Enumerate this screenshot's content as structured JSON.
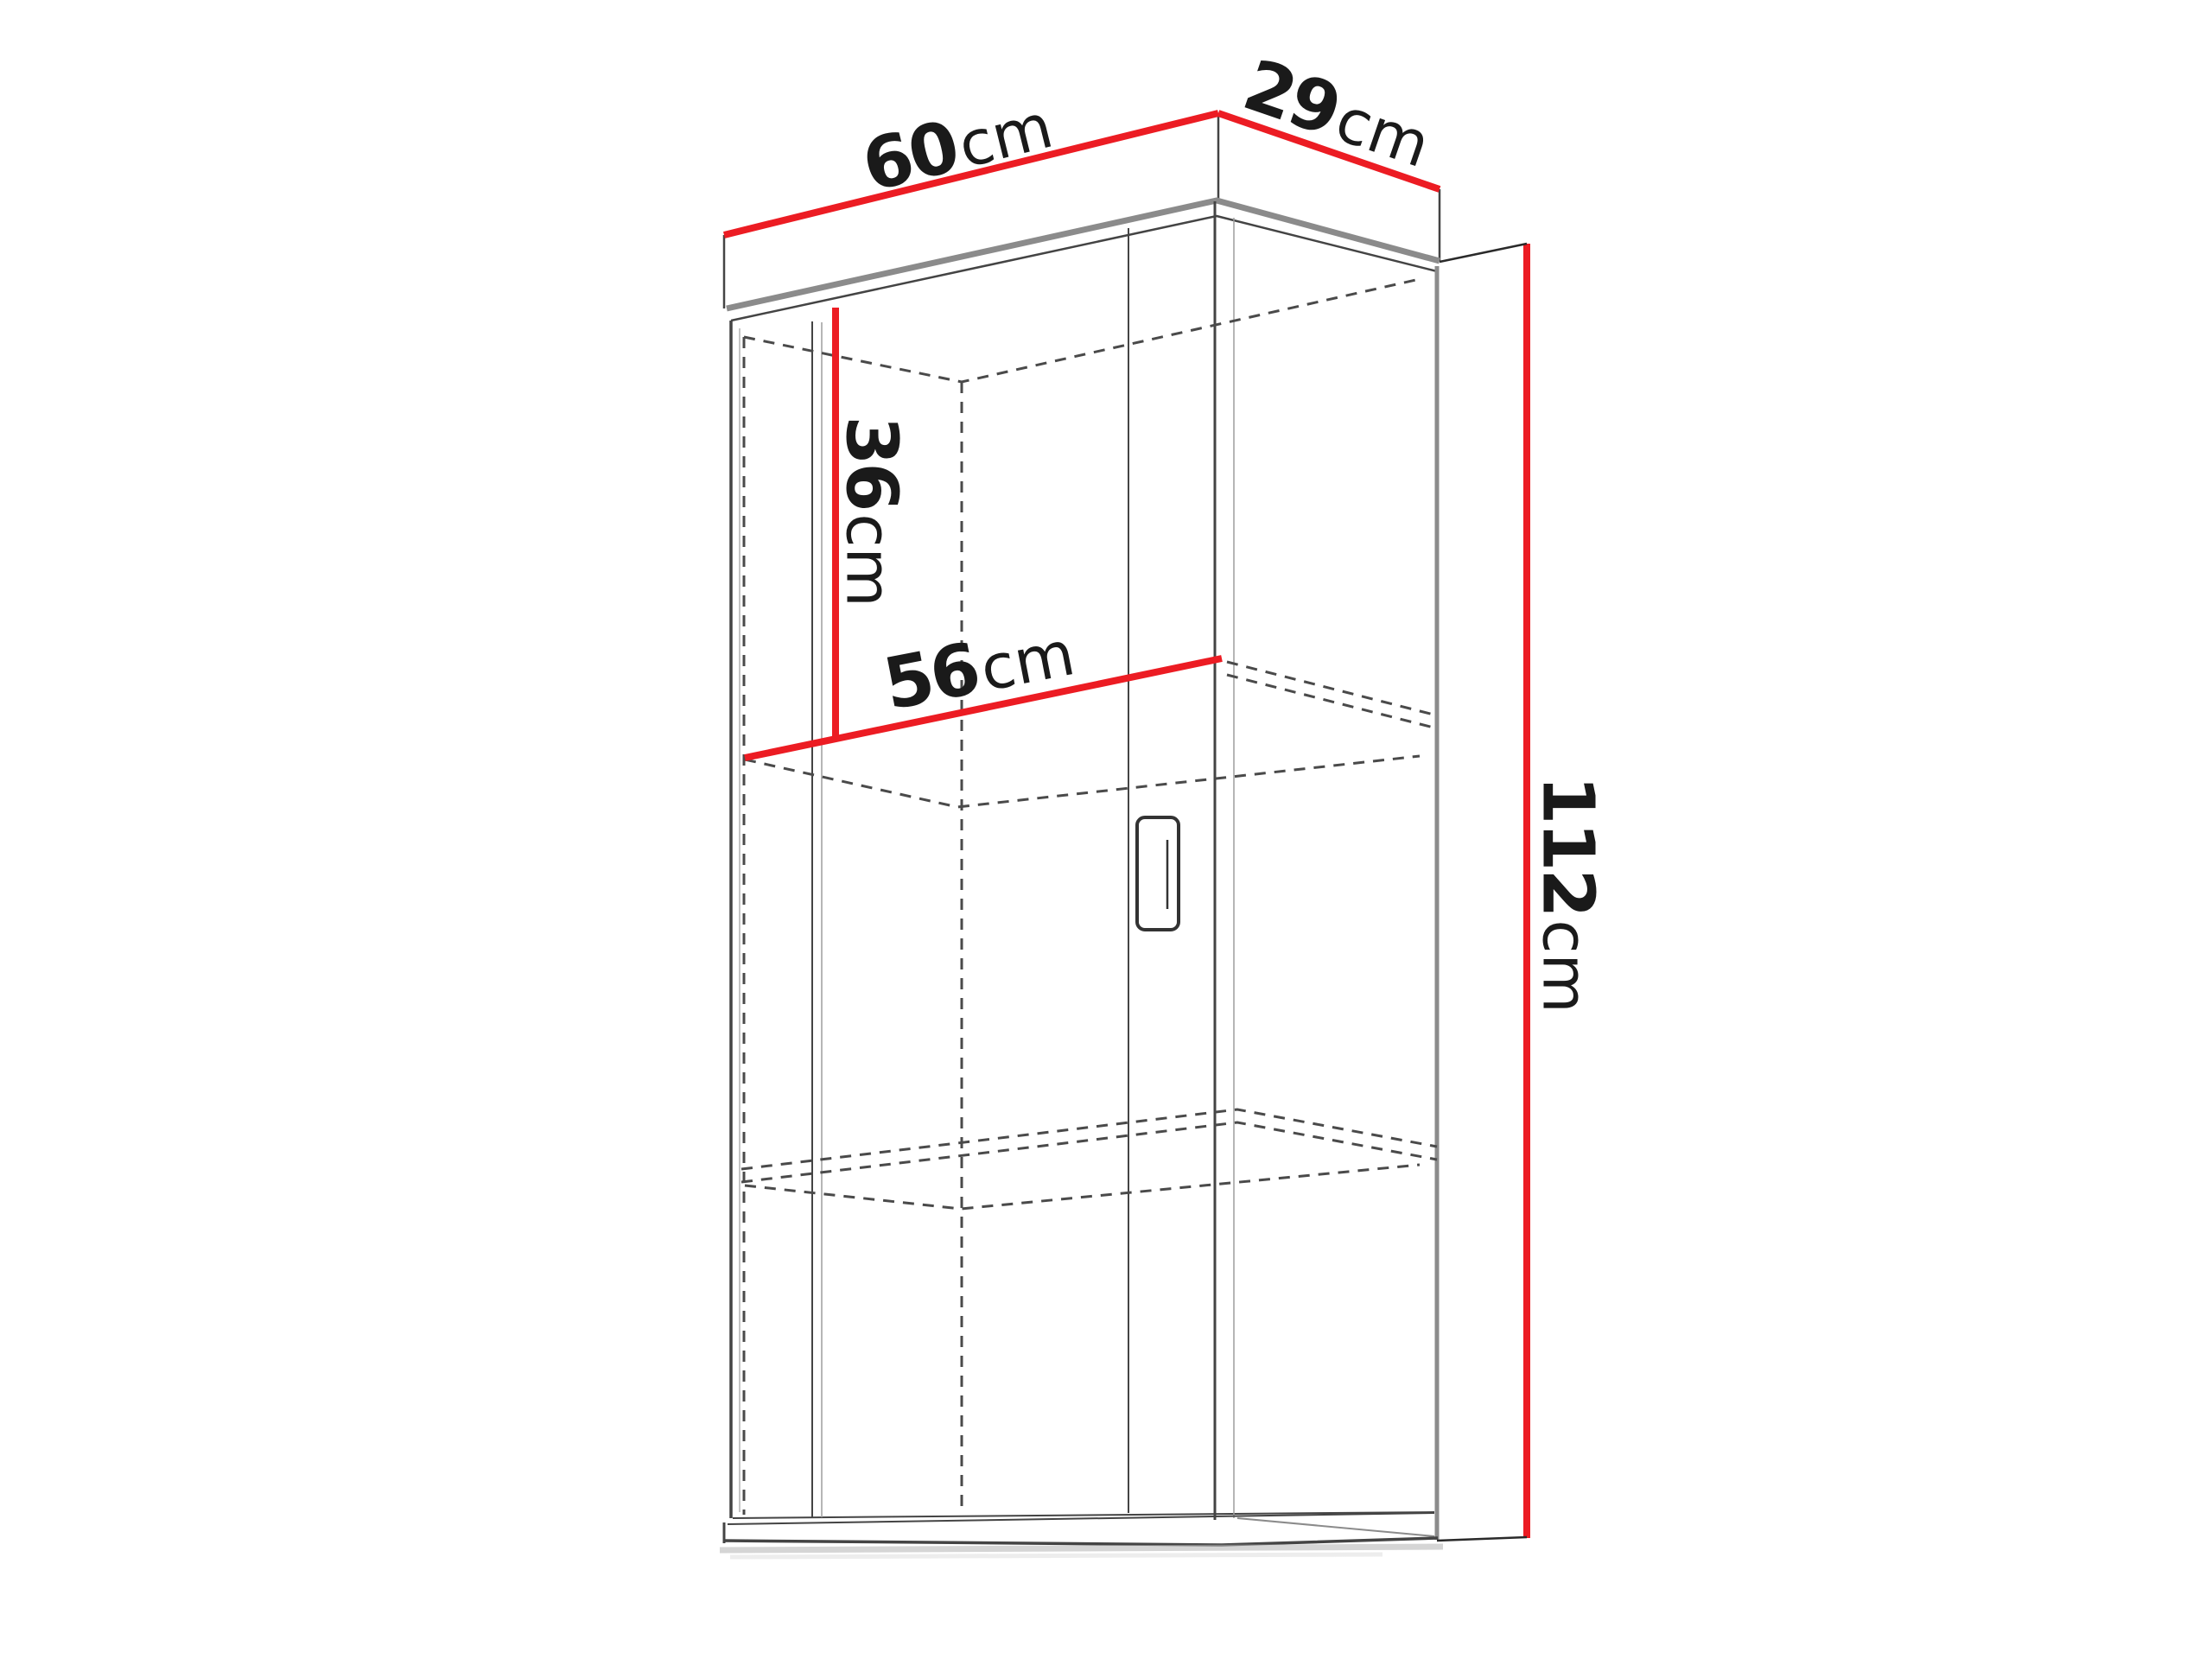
{
  "colors": {
    "background": "#ffffff",
    "dimension-red": "#ec1c23",
    "text-dark": "#1a1a1a",
    "outline-dark": "#444444",
    "outline-grey": "#8b8b8b",
    "outline-light": "#9e9e9e",
    "dashed-grey": "#4a4a4a"
  },
  "diagram": {
    "type": "furniture-dimension-drawing",
    "object": "wall-mounted cabinet with door and interior shelves, shown in perspective with red dimension lines",
    "dimensions": {
      "width": {
        "value": "60",
        "unit": "cm"
      },
      "depth": {
        "value": "29",
        "unit": "cm"
      },
      "height": {
        "value": "112",
        "unit": "cm"
      },
      "top_compartment_height": {
        "value": "36",
        "unit": "cm"
      },
      "shelf_width": {
        "value": "56",
        "unit": "cm"
      }
    }
  }
}
